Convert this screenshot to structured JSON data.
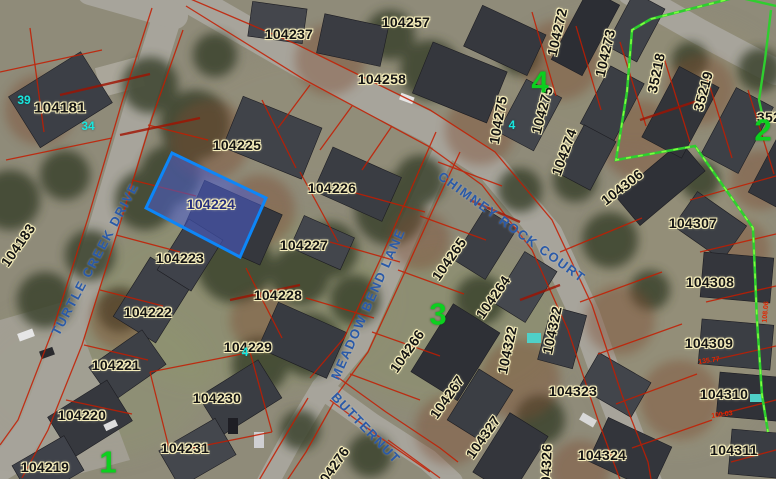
{
  "map": {
    "description": "GIS parcel viewer - aerial imagery with parcel overlay",
    "selected_parcel": {
      "id": "104224",
      "x": 211,
      "y": 204,
      "r": 0,
      "polygon": "172,153 266,198 240,257 146,208",
      "fill": "#4a5ed2",
      "outline": "#0d86f8"
    },
    "parcel_labels": [
      {
        "id": "104181",
        "x": 60,
        "y": 108,
        "r": 0,
        "size": "big"
      },
      {
        "id": "104183",
        "x": 18,
        "y": 245,
        "r": -55
      },
      {
        "id": "104237",
        "x": 289,
        "y": 34,
        "r": 0
      },
      {
        "id": "104257",
        "x": 406,
        "y": 22,
        "r": 0
      },
      {
        "id": "104258",
        "x": 382,
        "y": 79,
        "r": 0
      },
      {
        "id": "104225",
        "x": 237,
        "y": 145,
        "r": 0
      },
      {
        "id": "104226",
        "x": 332,
        "y": 188,
        "r": 0
      },
      {
        "id": "104227",
        "x": 304,
        "y": 245,
        "r": 0
      },
      {
        "id": "104223",
        "x": 180,
        "y": 258,
        "r": 0
      },
      {
        "id": "104228",
        "x": 278,
        "y": 295,
        "r": 0
      },
      {
        "id": "104222",
        "x": 148,
        "y": 312,
        "r": 0
      },
      {
        "id": "104221",
        "x": 116,
        "y": 365,
        "r": 0
      },
      {
        "id": "104229",
        "x": 248,
        "y": 347,
        "r": 0
      },
      {
        "id": "104220",
        "x": 82,
        "y": 415,
        "r": 0
      },
      {
        "id": "104230",
        "x": 217,
        "y": 398,
        "r": 0
      },
      {
        "id": "104231",
        "x": 185,
        "y": 448,
        "r": 0
      },
      {
        "id": "104219",
        "x": 45,
        "y": 467,
        "r": 0
      },
      {
        "id": "104265",
        "x": 449,
        "y": 259,
        "r": -55
      },
      {
        "id": "104264",
        "x": 493,
        "y": 297,
        "r": -55
      },
      {
        "id": "104266",
        "x": 407,
        "y": 351,
        "r": -55
      },
      {
        "id": "104267",
        "x": 447,
        "y": 397,
        "r": -55
      },
      {
        "id": "104327",
        "x": 483,
        "y": 437,
        "r": -55
      },
      {
        "id": "104276",
        "x": 332,
        "y": 468,
        "r": -55
      },
      {
        "id": "104326",
        "x": 546,
        "y": 468,
        "r": -88
      },
      {
        "id": "104322",
        "x": 507,
        "y": 350,
        "r": -78
      },
      {
        "id": "104322",
        "x": 552,
        "y": 330,
        "r": -78
      },
      {
        "id": "104323",
        "x": 573,
        "y": 391,
        "r": 0
      },
      {
        "id": "104324",
        "x": 602,
        "y": 455,
        "r": 0
      },
      {
        "id": "104309",
        "x": 709,
        "y": 343,
        "r": 0
      },
      {
        "id": "104310",
        "x": 724,
        "y": 394,
        "r": 0
      },
      {
        "id": "104311",
        "x": 734,
        "y": 450,
        "r": 0
      },
      {
        "id": "104308",
        "x": 710,
        "y": 282,
        "r": 0
      },
      {
        "id": "104307",
        "x": 693,
        "y": 223,
        "r": 0
      },
      {
        "id": "104306",
        "x": 622,
        "y": 187,
        "r": -38
      },
      {
        "id": "104272",
        "x": 557,
        "y": 32,
        "r": -77
      },
      {
        "id": "104273",
        "x": 605,
        "y": 53,
        "r": -77
      },
      {
        "id": "104275",
        "x": 498,
        "y": 120,
        "r": -80
      },
      {
        "id": "104275",
        "x": 542,
        "y": 110,
        "r": -75
      },
      {
        "id": "104274",
        "x": 564,
        "y": 152,
        "r": -70
      },
      {
        "id": "35218",
        "x": 656,
        "y": 73,
        "r": -78
      },
      {
        "id": "35219",
        "x": 703,
        "y": 91,
        "r": -75
      },
      {
        "id": "352",
        "x": 769,
        "y": 117,
        "r": 0
      }
    ],
    "street_labels": [
      {
        "text": "TURTLE CREEK DRIVE",
        "x": 95,
        "y": 259,
        "r": -62
      },
      {
        "text": "CHIMNEY ROCK COURT",
        "x": 512,
        "y": 227,
        "r": 36
      },
      {
        "text": "MEADOW BEND LANE",
        "x": 368,
        "y": 304,
        "r": -66
      },
      {
        "text": "BUTTERNUT",
        "x": 366,
        "y": 428,
        "r": 46
      }
    ],
    "block_numbers": [
      {
        "n": "4",
        "x": 540,
        "y": 82
      },
      {
        "n": "3",
        "x": 438,
        "y": 314
      },
      {
        "n": "2",
        "x": 763,
        "y": 130
      },
      {
        "n": "1",
        "x": 108,
        "y": 462
      }
    ],
    "house_numbers": [
      {
        "n": "39",
        "x": 24,
        "y": 100
      },
      {
        "n": "34",
        "x": 88,
        "y": 126
      },
      {
        "n": "4",
        "x": 512,
        "y": 125
      },
      {
        "n": "4",
        "x": 245,
        "y": 352
      }
    ],
    "dimension_labels": [
      {
        "text": "135.77",
        "x": 709,
        "y": 361,
        "r": -8
      },
      {
        "text": "100.03",
        "x": 722,
        "y": 415,
        "r": -8
      },
      {
        "text": "108.06",
        "x": 766,
        "y": 312,
        "r": -85
      }
    ],
    "colors": {
      "parcel_text": "#141414",
      "parcel_halo": "#f5edbb",
      "selected_text": "#27307e",
      "street_text": "#2a5aa8",
      "block_text": "#0cd01f",
      "house_text": "#19e6de",
      "dimension_text": "#e22500",
      "parcel_line_red": "#c41c00",
      "boundary_green": "#35e135",
      "selection_blue": "#0d86f8"
    }
  }
}
